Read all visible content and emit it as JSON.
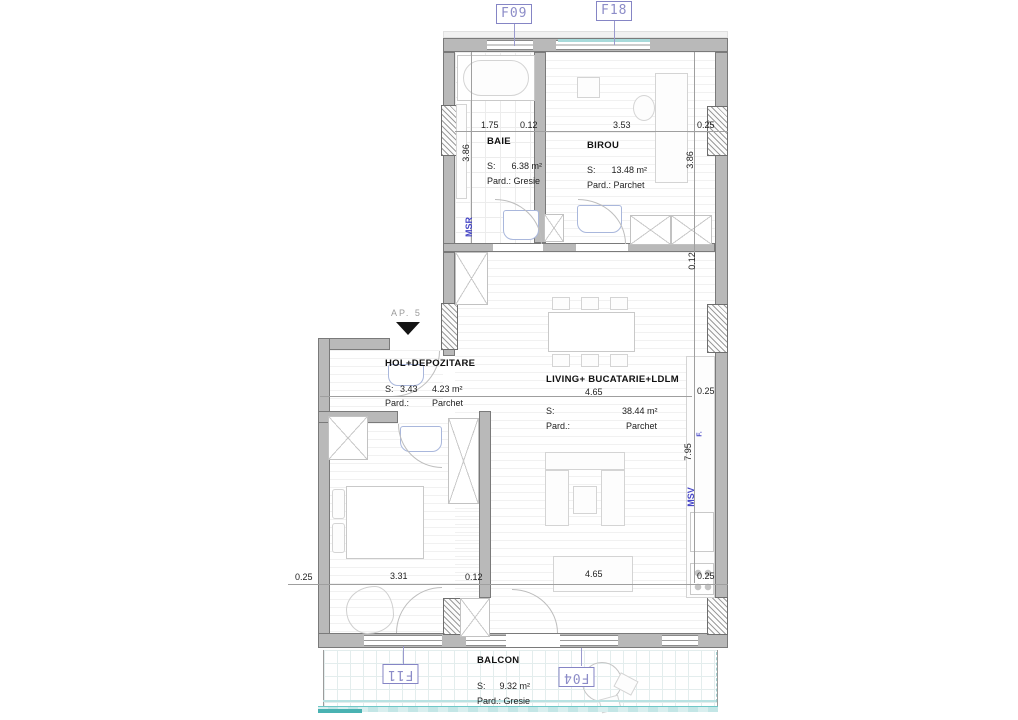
{
  "rooms": {
    "baie": {
      "name": "BAIE",
      "s": "S:",
      "area": "6.38 m²",
      "pard": "Pard.: Gresie"
    },
    "birou": {
      "name": "BIROU",
      "s": "S:",
      "area": "13.48 m²",
      "pard": "Pard.: Parchet"
    },
    "hol": {
      "name": "HOL+DEPOZITARE",
      "s": "S:",
      "area": "4.23 m²",
      "pard": "Pard.:",
      "pard_value": "Parchet"
    },
    "living": {
      "name": "LIVING+ BUCATARIE+LDLM",
      "s": "S:",
      "area": "38.44 m²",
      "pard": "Pard.:",
      "pard_value": "Parchet"
    },
    "balcon": {
      "name": "BALCON",
      "s": "S:",
      "area": "9.32 m²",
      "pard": "Pard.: Gresie"
    }
  },
  "dims": {
    "top": [
      "1.75",
      "0.12",
      "3.53",
      "0.25"
    ],
    "left": [
      "3.86"
    ],
    "right": [
      "3.86",
      "0.12",
      "0.25",
      "7.95"
    ],
    "mid": [
      "3.43",
      "4.65"
    ],
    "bottom": [
      "0.25",
      "3.31",
      "0.12",
      "4.65",
      "0.25"
    ]
  },
  "window_tags": {
    "f09": "F09",
    "f18": "F18",
    "f11": "F11",
    "f04": "F04"
  },
  "wall_annotations": {
    "msr": "MSR",
    "msv": "MSV",
    "f": "F."
  },
  "entrance_label": "AP. 5",
  "colors": {
    "wall": "#b9b9b9",
    "glass_teal": "#63c6c6",
    "tag_blue": "#8c8cc8",
    "annotation_blue": "#4646c6"
  }
}
